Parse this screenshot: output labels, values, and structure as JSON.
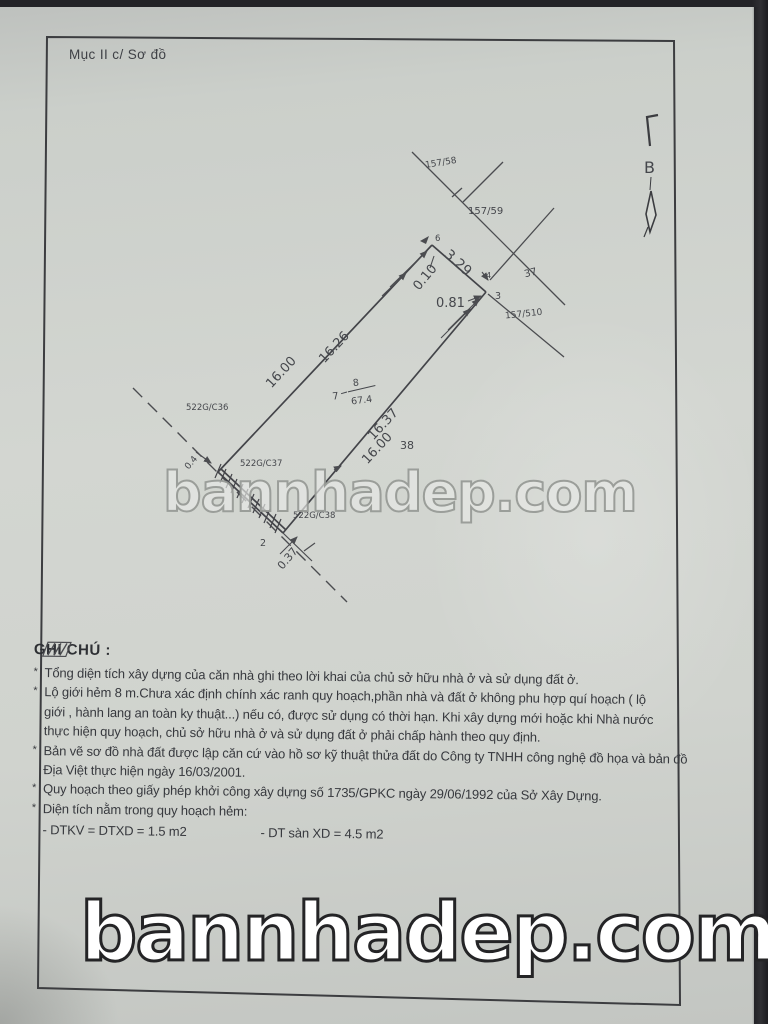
{
  "page": {
    "header": "Mục II c/ Sơ đồ",
    "colors": {
      "paper": "#d2d5d0",
      "ink": "#3a3c40",
      "line": "#4b4c50",
      "watermark_outline": "#9da09b"
    }
  },
  "watermark": {
    "middle": "bannhadep.com",
    "bottom": "bannhadep.com"
  },
  "north": {
    "label": "B"
  },
  "diagram": {
    "labels": {
      "p15758": "157/58",
      "p15759": "157/59",
      "p157510": "157/510",
      "n37": "37",
      "n38": "38",
      "c36": "522G/C36",
      "c37": "522G/C37",
      "c38": "522G/C38",
      "len_left_outer": "16.00",
      "len_left_inner": "16.26",
      "len_right_inner": "16.37",
      "len_right_outer": "16.00",
      "top_edge": "3.29",
      "off_010": "0.10",
      "off_081": "0.81",
      "off_037": "0.37",
      "off_04": "0.4",
      "lot_no": "7",
      "house_no": "8",
      "area": "67.4",
      "pt6": "6",
      "pt4": "4",
      "pt3": "3",
      "pt2": "2"
    }
  },
  "notes": {
    "heading": "GHI CHÚ :",
    "bullet": "*",
    "lines": [
      "Tổng diện tích xây dựng của căn nhà ghi theo lời khai của chủ sở hữu nhà ở và sử dụng đất ở.",
      "Lộ giới hẻm 8 m.Chưa xác định chính xác ranh quy hoạch,phần nhà và đất ở không phu hợp quí hoạch ( lộ",
      "giới , hành lang an toàn ky thuật...) nếu có, được sử dụng có thời hạn. Khi xây dựng mới hoặc khi Nhà nước",
      "thực hiện quy hoạch, chủ sở hữu nhà ở và sử dụng đất ở phải  chấp hành theo quy định.",
      "Bản vẽ sơ đồ nhà đất được lập căn cứ vào hồ sơ kỹ thuật thửa đất do Công ty TNHH công nghệ đồ họa và bản đồ",
      "Địa Việt thực hiện ngày 16/03/2001.",
      "Quy hoạch theo giấy phép khởi công xây dựng số 1735/GPKC ngày 29/06/1992 của Sở Xây Dựng.",
      "Diện tích nằm trong quy hoạch hẻm:"
    ],
    "dtkv": "- DTKV = DTXD = 1.5  m2",
    "dt_san": "- DT sàn XD = 4.5 m2"
  }
}
